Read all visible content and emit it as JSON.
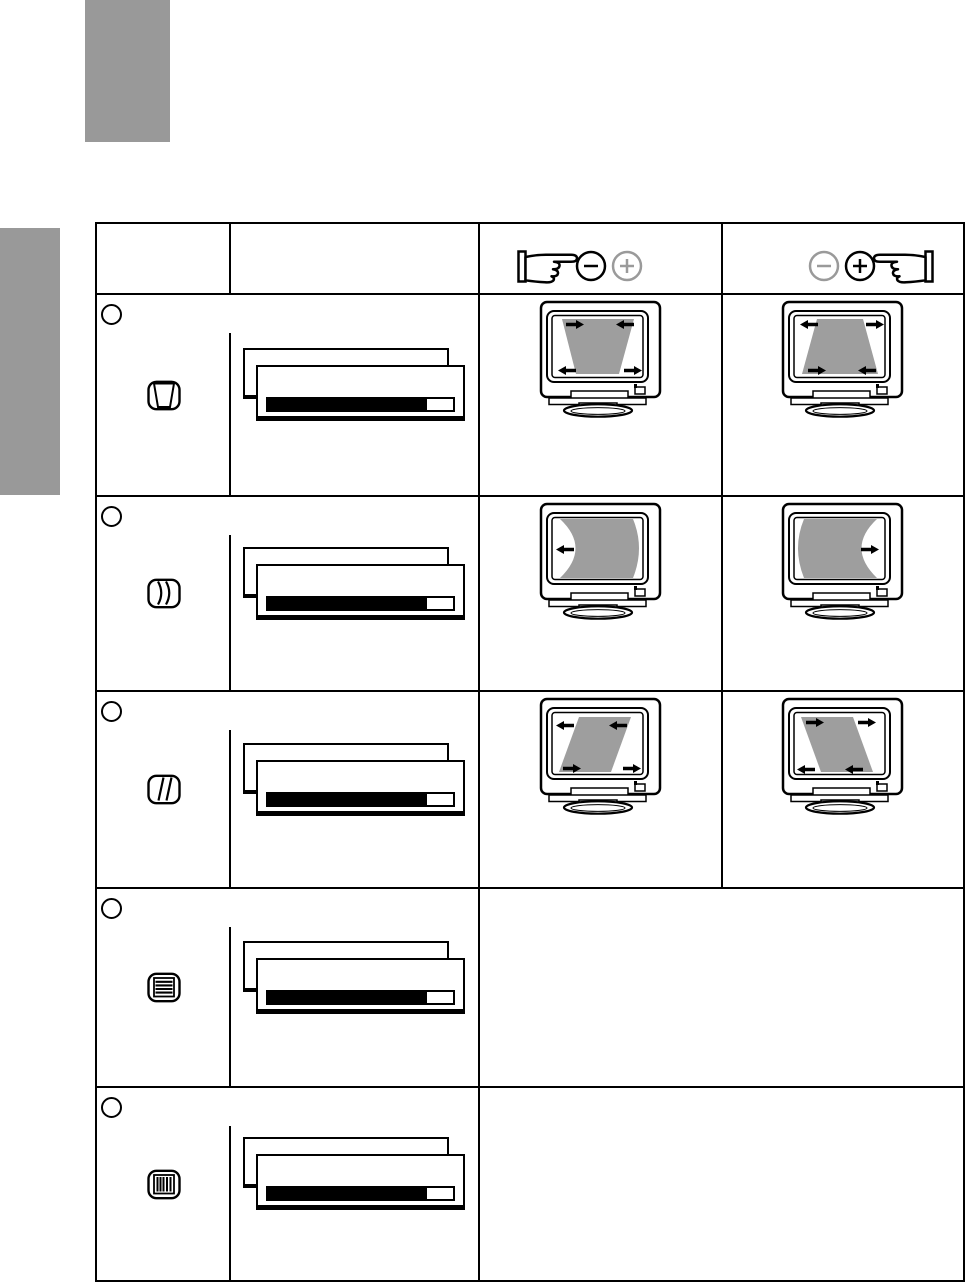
{
  "document": {
    "kind": "monitor user manual page — on-screen-display geometry adjustment table",
    "visible_text": [],
    "page_background": "#ffffff"
  },
  "decorations": {
    "top_chapter_tab": {
      "color": "#999999"
    },
    "left_section_tab": {
      "color": "#999999"
    }
  },
  "colors": {
    "line_art": "#000000",
    "tab_gray": "#999999",
    "screen_shape_gray": "#9e9e9e",
    "inactive_control_gray": "#9a9a9a",
    "slider_fill": "#000000"
  },
  "table": {
    "columns": [
      "adjustment-icon",
      "osd-menu-preview",
      "minus-button-effect",
      "plus-button-effect"
    ],
    "header": {
      "minus_column": {
        "hand": "pointing-hand-right",
        "buttons": [
          {
            "glyph": "minus",
            "state": "active"
          },
          {
            "glyph": "plus",
            "state": "inactive"
          }
        ]
      },
      "plus_column": {
        "hand": "pointing-hand-left",
        "buttons": [
          {
            "glyph": "minus",
            "state": "inactive"
          },
          {
            "glyph": "plus",
            "state": "active"
          }
        ]
      }
    },
    "osd_slider": {
      "fill_percent": 86,
      "fill_color": "#000000"
    },
    "rows": [
      {
        "bullet": "circle",
        "icon": "trapezoid-adjustment-icon",
        "minus_illustration": {
          "type": "crt-monitor",
          "shape": "gray trapezoid, wide top / narrow bottom",
          "arrows": "top pair inward, bottom pair outward"
        },
        "plus_illustration": {
          "type": "crt-monitor",
          "shape": "gray trapezoid, narrow top / wide bottom",
          "arrows": "top pair outward, bottom pair inward"
        }
      },
      {
        "bullet": "circle",
        "icon": "pincushion-balance-icon",
        "minus_illustration": {
          "type": "crt-monitor",
          "shape": "gray panel, both vertical edges bowed right",
          "arrows": "single left arrow at mid-left"
        },
        "plus_illustration": {
          "type": "crt-monitor",
          "shape": "gray panel, both vertical edges bowed left",
          "arrows": "single right arrow at mid-right"
        }
      },
      {
        "bullet": "circle",
        "icon": "parallelogram-adjustment-icon",
        "minus_illustration": {
          "type": "crt-monitor",
          "shape": "gray parallelogram leaning right",
          "arrows": "top pair left, bottom pair right"
        },
        "plus_illustration": {
          "type": "crt-monitor",
          "shape": "gray parallelogram leaning left",
          "arrows": "top pair right, bottom pair left"
        }
      },
      {
        "bullet": "circle",
        "icon": "horizontal-stripes-icon",
        "minus_illustration": null,
        "plus_illustration": null
      },
      {
        "bullet": "circle",
        "icon": "vertical-stripes-icon",
        "minus_illustration": null,
        "plus_illustration": null
      }
    ]
  }
}
